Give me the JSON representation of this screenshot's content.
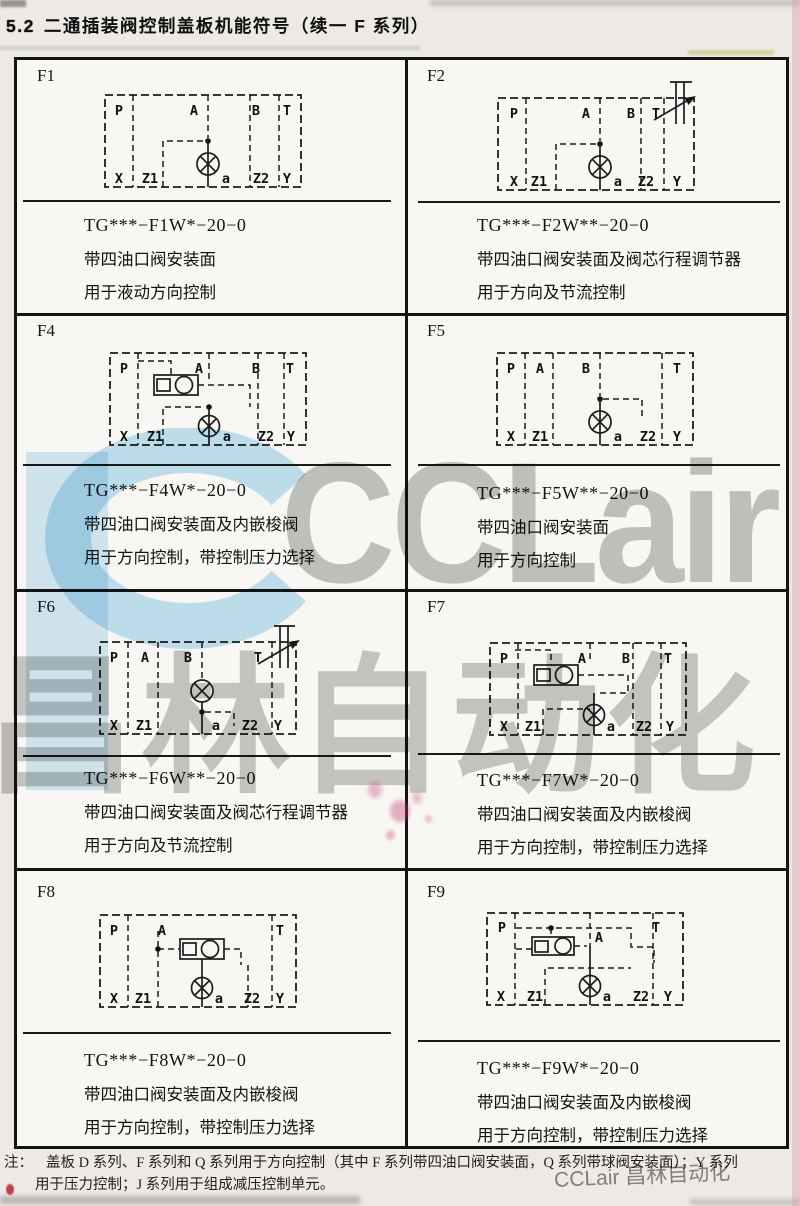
{
  "page": {
    "section_number": "5.2",
    "title": "二通插装阀控制盖板机能符号（续一  F 系列）",
    "note_label": "注：",
    "note_line1": "盖板 D 系列、F 系列和 Q 系列用于方向控制（其中 F 系列带四油口阀安装面，Q 系列带球阀安装面）；Y 系列",
    "note_line2": "用于压力控制；J 系列用于组成减压控制单元。",
    "watermark_logo_text": "CCLair",
    "watermark_cn_text": "昌林自动化",
    "watermark_corner_text": "CCLair 昌林自动化"
  },
  "colors": {
    "ink": "#1a1a1a",
    "page_bg": "#edeae5",
    "table_bg": "#f8f7f3",
    "watermark_gray": "#8d8d8d",
    "watermark_blue": "#b5dcf2",
    "stamp_pink": "#c84e86"
  },
  "cells": [
    {
      "id": "F1",
      "code": "TG***−F1W*−20−0",
      "desc1": "带四油口阀安装面",
      "desc2": "用于液动方向控制",
      "ports": {
        "top": [
          "P",
          "A",
          "B",
          "T"
        ],
        "bottom": [
          "X",
          "Z1",
          "a",
          "Z2",
          "Y"
        ]
      }
    },
    {
      "id": "F2",
      "code": "TG***−F2W**−20−0",
      "desc1": "带四油口阀安装面及阀芯行程调节器",
      "desc2": "用于方向及节流控制",
      "ports": {
        "top": [
          "P",
          "A",
          "B",
          "T"
        ],
        "bottom": [
          "X",
          "Z1",
          "a",
          "Z2",
          "Y"
        ]
      }
    },
    {
      "id": "F4",
      "code": "TG***−F4W*−20−0",
      "desc1": "带四油口阀安装面及内嵌梭阀",
      "desc2": "用于方向控制，带控制压力选择",
      "ports": {
        "top": [
          "P",
          "A",
          "B",
          "T"
        ],
        "bottom": [
          "X",
          "Z1",
          "a",
          "Z2",
          "Y"
        ]
      }
    },
    {
      "id": "F5",
      "code": "TG***−F5W**−20−0",
      "desc1": "带四油口阀安装面",
      "desc2": "用于方向控制",
      "ports": {
        "top": [
          "P",
          "A",
          "B",
          "T"
        ],
        "bottom": [
          "X",
          "Z1",
          "a",
          "Z2",
          "Y"
        ]
      }
    },
    {
      "id": "F6",
      "code": "TG***−F6W**−20−0",
      "desc1": "带四油口阀安装面及阀芯行程调节器",
      "desc2": "用于方向及节流控制",
      "ports": {
        "top": [
          "P",
          "A",
          "B",
          "T"
        ],
        "bottom": [
          "X",
          "Z1",
          "a",
          "Z2",
          "Y"
        ]
      }
    },
    {
      "id": "F7",
      "code": "TG***−F7W*−20−0",
      "desc1": "带四油口阀安装面及内嵌梭阀",
      "desc2": "用于方向控制，带控制压力选择",
      "ports": {
        "top": [
          "P",
          "A",
          "B",
          "T"
        ],
        "bottom": [
          "X",
          "Z1",
          "a",
          "Z2",
          "Y"
        ]
      }
    },
    {
      "id": "F8",
      "code": "TG***−F8W*−20−0",
      "desc1": "带四油口阀安装面及内嵌梭阀",
      "desc2": "用于方向控制，带控制压力选择",
      "ports": {
        "top": [
          "P",
          "A",
          "T"
        ],
        "bottom": [
          "X",
          "Z1",
          "a",
          "Z2",
          "Y"
        ]
      }
    },
    {
      "id": "F9",
      "code": "TG***−F9W*−20−0",
      "desc1": "带四油口阀安装面及内嵌梭阀",
      "desc2": "用于方向控制，带控制压力选择",
      "ports": {
        "top": [
          "P",
          "A",
          "T"
        ],
        "bottom": [
          "X",
          "Z1",
          "a",
          "Z2",
          "Y"
        ]
      }
    }
  ]
}
